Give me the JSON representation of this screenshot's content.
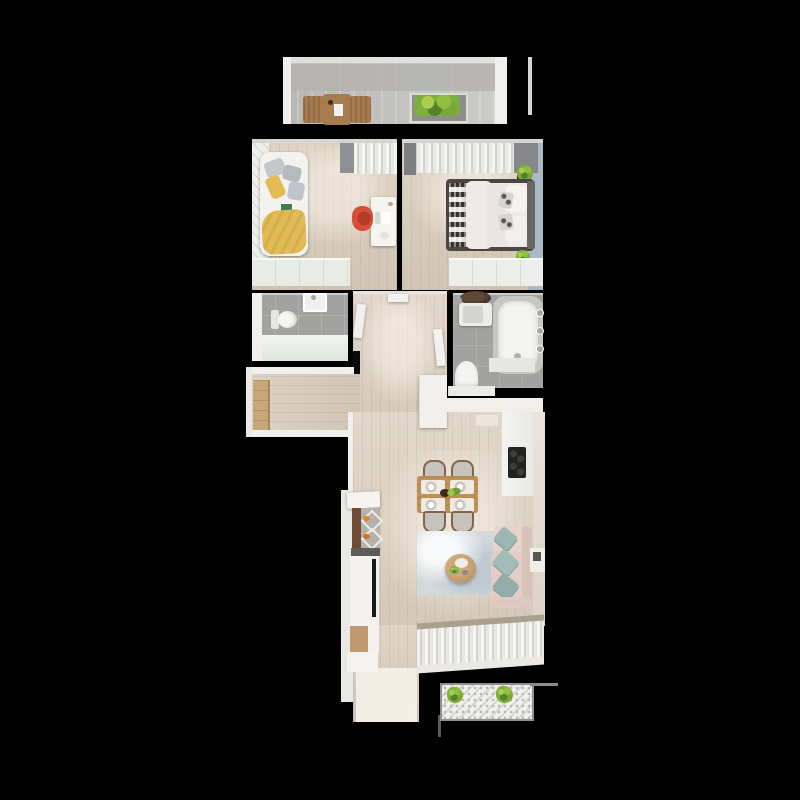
{
  "scene": {
    "type": "apartment-floor-plan-3d-top-view",
    "width": 800,
    "height": 800,
    "background": "#000000",
    "has_text": false
  },
  "palette": {
    "background": "#000000",
    "wall_white": "#f0efeb",
    "wall_dim": "#d6d5d1",
    "wood_floor": "#d9ccbb",
    "wood_floor_light": "#e7dccc",
    "tile_grey": "#a2a2a0",
    "concrete": "#c2c1bd",
    "blue_wall": "#aab9c8",
    "curtain_grey": "#8e9093",
    "curtain_white": "#f4f4f2",
    "yellow_blanket": "#e2bb54",
    "red_chair": "#d84e34",
    "teal_cushion": "#9cb6b1",
    "sofa_pink": "#e3cec7",
    "rug_blue": "#d2d9dd",
    "table_wood": "#bd9257",
    "dark_wood": "#6f4c33",
    "tan_wardrobe": "#c8a878",
    "plant_green": "#7daf3e",
    "plant_dark": "#55822a",
    "tv_black": "#1a1a1a",
    "chrome": "#a6a6a4",
    "cooktop_black": "#222220"
  },
  "rooms": [
    {
      "id": "balcony-top",
      "contents": [
        "wooden-chairs",
        "wooden-table",
        "planter-box"
      ]
    },
    {
      "id": "kids-room",
      "contents": [
        "bed-yellow-blanket",
        "grey-pillows",
        "desk",
        "red-chair",
        "wardrobe",
        "curtains"
      ]
    },
    {
      "id": "bedroom",
      "contents": [
        "double-bed",
        "patterned-runner",
        "pillows",
        "plants",
        "dresser",
        "curtains",
        "blue-accent-wall"
      ]
    },
    {
      "id": "wc",
      "contents": [
        "toilet",
        "sink",
        "counter"
      ]
    },
    {
      "id": "hallway",
      "contents": [
        "open-doors",
        "closet"
      ]
    },
    {
      "id": "bathroom",
      "contents": [
        "bathtub",
        "round-basin-table",
        "washer",
        "toilet"
      ]
    },
    {
      "id": "corridor",
      "contents": [
        "tall-wardrobe"
      ]
    },
    {
      "id": "kitchen-living",
      "contents": [
        "kitchen-counter",
        "cooktop",
        "bar-stools",
        "tv-cabinet",
        "dining-table",
        "four-chairs",
        "rug",
        "coffee-table",
        "sofa-teal-cushions",
        "window-curtains"
      ]
    },
    {
      "id": "balcony-bottom",
      "contents": [
        "two-plants",
        "perforated-floor"
      ]
    }
  ]
}
